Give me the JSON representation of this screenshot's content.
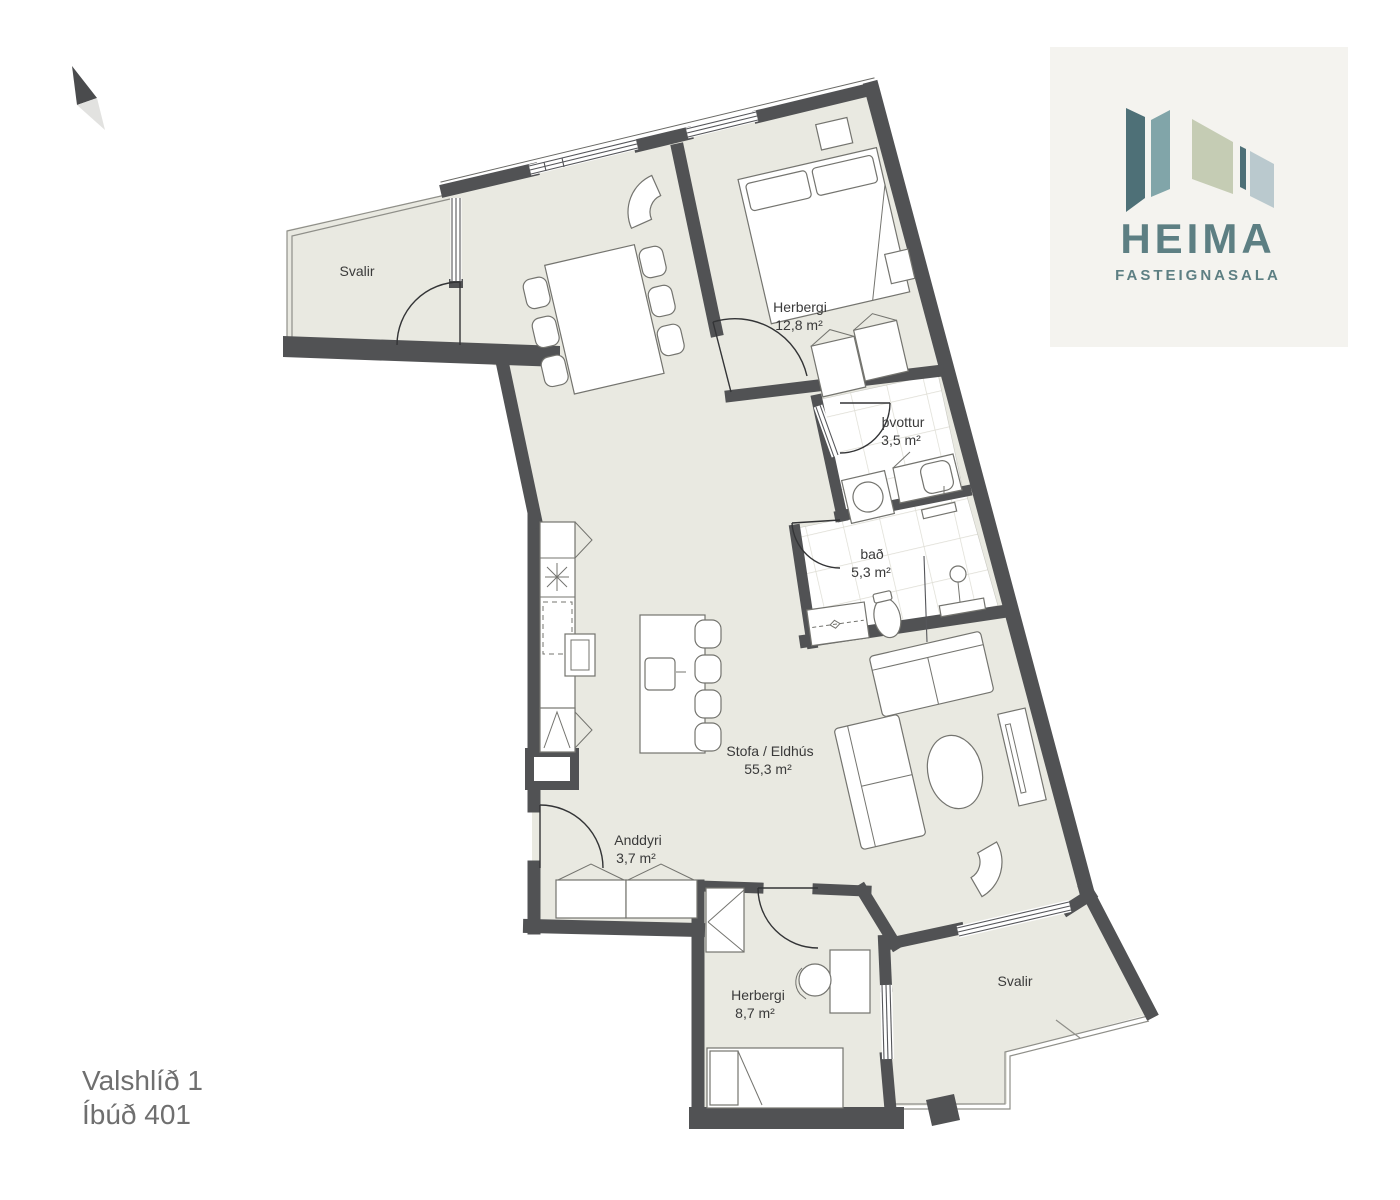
{
  "address": {
    "street": "Valshlíð 1",
    "unit": "Íbúð 401"
  },
  "logo": {
    "brand": "HEIMA",
    "subtitle": "FASTEIGNASALA"
  },
  "rooms": [
    {
      "id": "svalir-top",
      "name": "Svalir",
      "area": ""
    },
    {
      "id": "herbergi-main",
      "name": "Herbergi",
      "area": "12,8 m²"
    },
    {
      "id": "thvottur",
      "name": "þvottur",
      "area": "3,5 m²"
    },
    {
      "id": "bad",
      "name": "bað",
      "area": "5,3 m²"
    },
    {
      "id": "stofa-eldhus",
      "name": "Stofa / Eldhús",
      "area": "55,3 m²"
    },
    {
      "id": "anddyri",
      "name": "Anddyri",
      "area": "3,7 m²"
    },
    {
      "id": "herbergi-small",
      "name": "Herbergi",
      "area": "8,7 m²"
    },
    {
      "id": "svalir-bottom",
      "name": "Svalir",
      "area": ""
    }
  ],
  "palette": {
    "floor": "#e9e9e1",
    "wall": "#515254",
    "tile_line": "#dddcd3",
    "label_text": "#3a3a3a",
    "address_text": "#6f6f6f",
    "logo_text": "#5d7f83",
    "logo_panel": "#f4f3ef",
    "logo_slat_dark_teal": "#4e7077",
    "logo_slat_teal": "#81a5a9",
    "logo_slat_sage": "#c5ccb4",
    "logo_slat_blue_gray": "#bac9ce",
    "north_dark": "#4a4b4d",
    "north_light": "#e2e2e0"
  }
}
